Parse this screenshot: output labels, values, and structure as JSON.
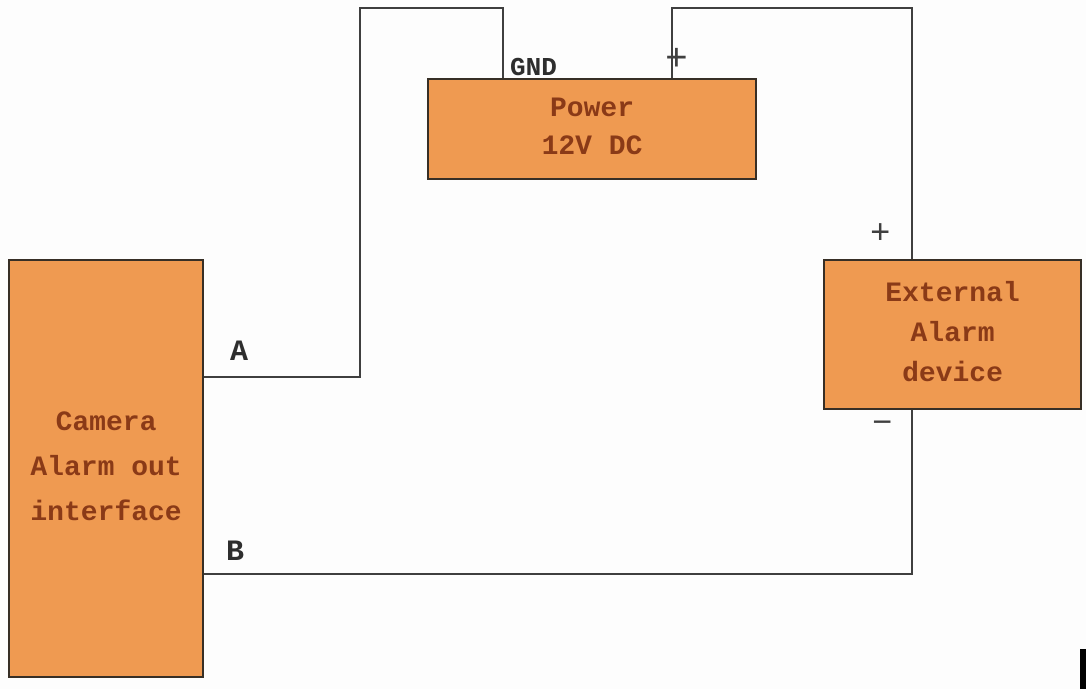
{
  "diagram": {
    "type": "wiring-diagram",
    "boxes": {
      "camera": {
        "lines": [
          "Camera",
          "Alarm out",
          "interface"
        ]
      },
      "power": {
        "lines": [
          "Power",
          "12V DC"
        ]
      },
      "external": {
        "lines": [
          "External",
          "Alarm",
          "device"
        ]
      }
    },
    "labels": {
      "wire_a": "A",
      "wire_b": "B",
      "gnd": "GND",
      "power_plus": "+",
      "external_plus": "+",
      "external_minus": "−"
    },
    "colors": {
      "box_fill": "#ef9a51",
      "box_border": "#372f26",
      "box_text": "#8a3a17",
      "wire": "#3f3f3f",
      "label_text": "#2e2e2e",
      "background": "#fdfdfd"
    }
  }
}
